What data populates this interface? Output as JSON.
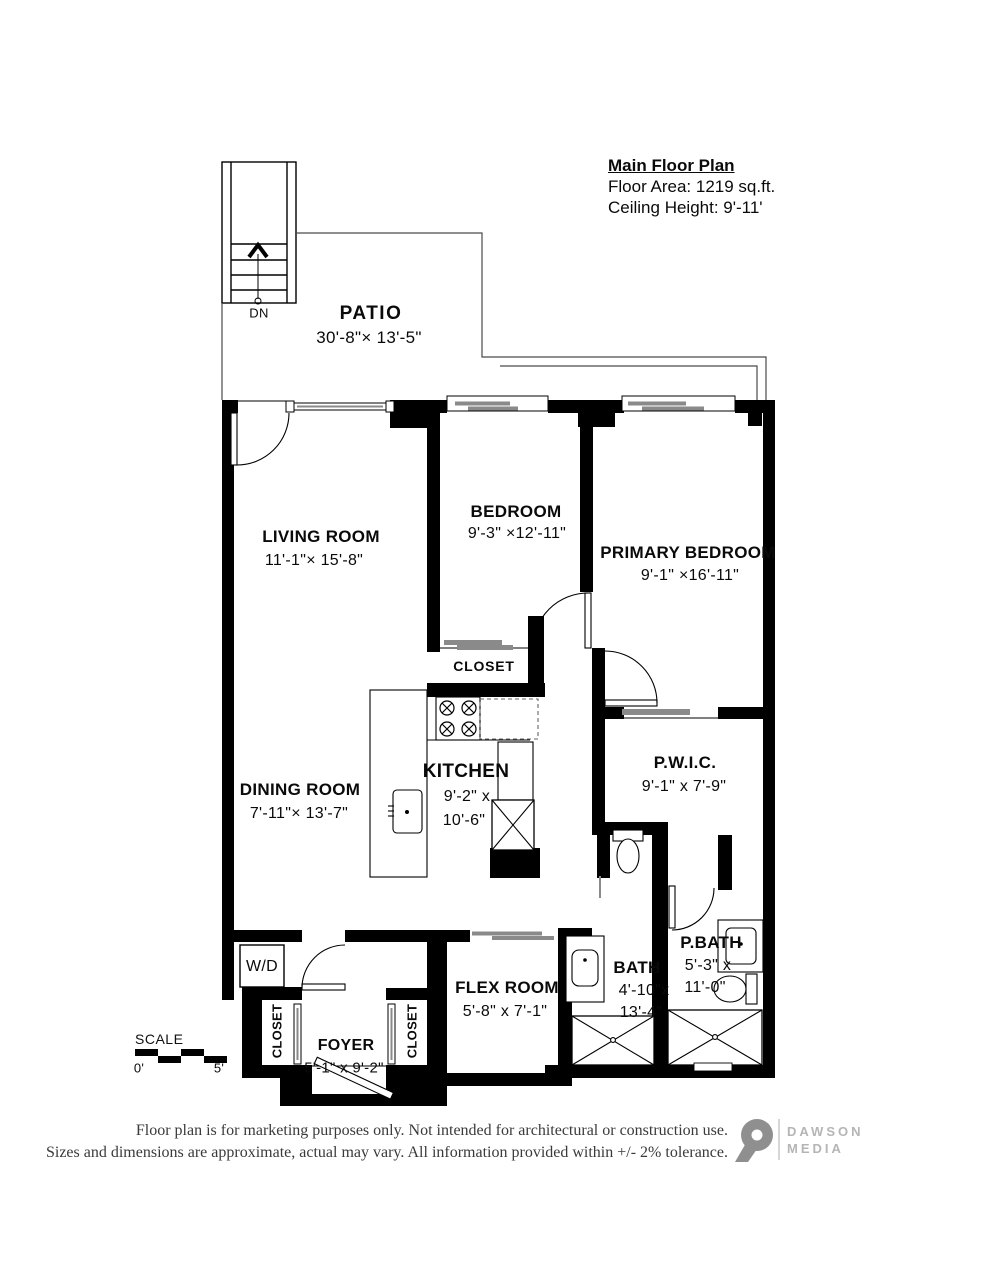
{
  "header": {
    "title": "Main Floor Plan",
    "floor_area": "Floor Area: 1219 sq.ft.",
    "ceiling_height": "Ceiling Height: 9'-11'"
  },
  "stairs": {
    "down_label": "DN"
  },
  "rooms": {
    "patio": {
      "name": "PATIO",
      "dims": "30'-8\"× 13'-5\""
    },
    "living": {
      "name": "LIVING ROOM",
      "dims": "11'-1\"× 15'-8\""
    },
    "bedroom": {
      "name": "BEDROOM",
      "dims": "9'-3\" ×12'-11\""
    },
    "primary": {
      "name": "PRIMARY BEDROOM",
      "dims": "9'-1\" ×16'-11\""
    },
    "closet_bedroom": {
      "name": "CLOSET"
    },
    "kitchen": {
      "name": "KITCHEN",
      "dims_line1": "9'-2\" x",
      "dims_line2": "10'-6\""
    },
    "dining": {
      "name": "DINING ROOM",
      "dims": "7'-11\"× 13'-7\""
    },
    "pwic": {
      "name": "P.W.I.C.",
      "dims": "9'-1\" x 7'-9\""
    },
    "bath": {
      "name": "BATH",
      "dims_line1": "4'-10\"x",
      "dims_line2": "13'-4\""
    },
    "pbath": {
      "name": "P.BATH",
      "dims_line1": "5'-3\" x",
      "dims_line2": "11'-0\""
    },
    "flex": {
      "name": "FLEX ROOM",
      "dims": "5'-8\" x 7'-1\""
    },
    "wd": {
      "name": "W/D"
    },
    "closet_foyer_left": {
      "name": "CLOSET"
    },
    "closet_foyer_right": {
      "name": "CLOSET"
    },
    "foyer": {
      "name": "FOYER",
      "dims": "5'-1\" x 9'-2\""
    }
  },
  "scale": {
    "label": "SCALE",
    "min": "0'",
    "max": "5'"
  },
  "footer": {
    "line1": "Floor plan is for marketing purposes only. Not intended for architectural or construction use.",
    "line2": "Sizes and dimensions are approximate, actual may vary. All information provided within +/- 2% tolerance."
  },
  "logo": {
    "name_line1": "DAWSON",
    "name_line2": "MEDIA"
  },
  "colors": {
    "wall": "#000000",
    "glass_bar": "#8a8a8a",
    "logo_gray": "#8f8f8f",
    "logo_text": "#b5b5b5",
    "footer_text": "#3a3a3a"
  }
}
